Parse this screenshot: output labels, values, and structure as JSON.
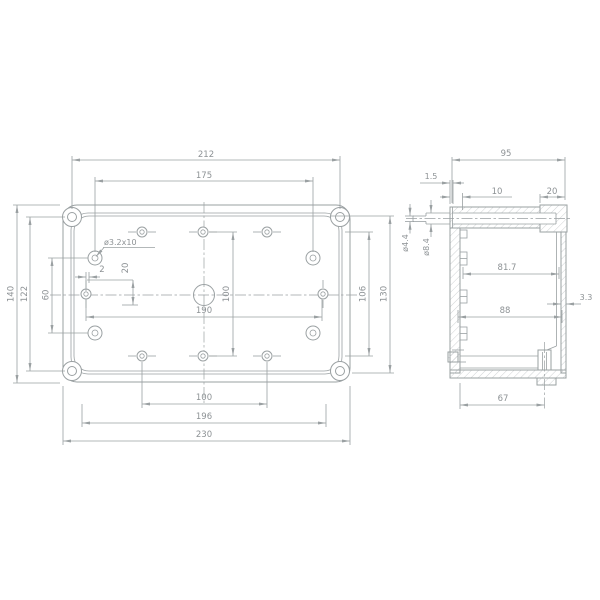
{
  "document": {
    "type": "technical-drawing",
    "background": "#ffffff",
    "line_color": "#9aa0a2",
    "text_color": "#8d9295",
    "hatch_color": "#c3c7c9"
  },
  "front_view": {
    "dimensions": {
      "top": [
        "212",
        "175"
      ],
      "left": [
        "140",
        "122",
        "60"
      ],
      "right": [
        "106",
        "130"
      ],
      "bottom": [
        "100",
        "196",
        "230"
      ],
      "internal": {
        "offset": "2",
        "slot": "20",
        "span": "190",
        "vertical": "100"
      },
      "hole_callout": "ø3.2x10"
    }
  },
  "side_view": {
    "dimensions": {
      "top": [
        "95",
        "1.5",
        "10",
        "20"
      ],
      "left": [
        "ø4.4",
        "ø8.4"
      ],
      "internal": [
        "81.7",
        "88"
      ],
      "right": [
        "3.3"
      ],
      "bottom": [
        "67"
      ]
    }
  }
}
